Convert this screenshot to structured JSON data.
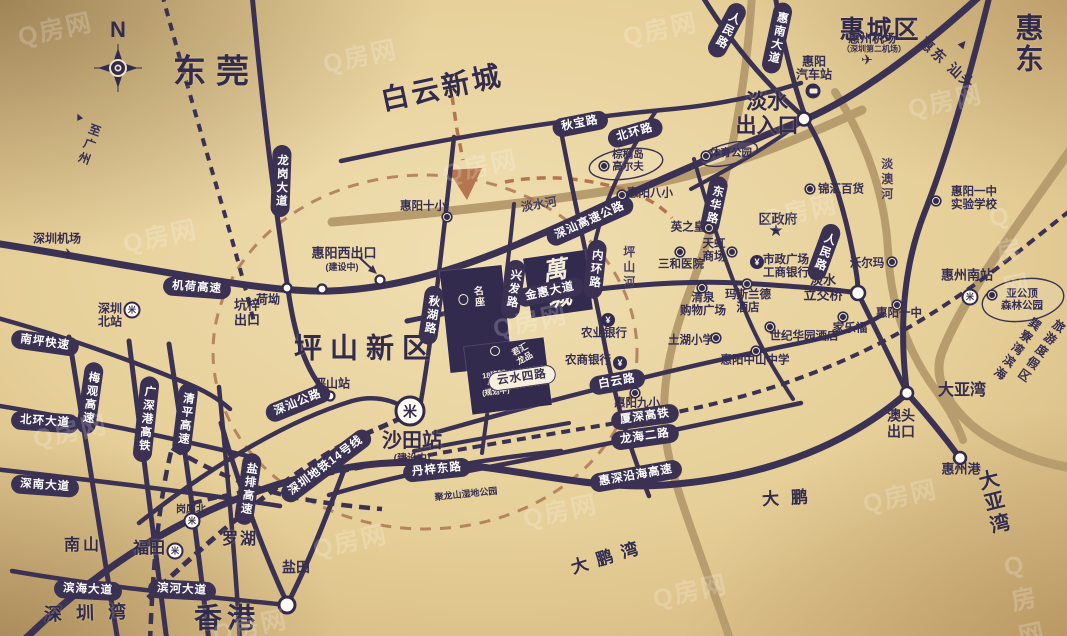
{
  "compass": {
    "label": "N"
  },
  "watermark": {
    "text": "Q房网"
  },
  "colors": {
    "road": "#3b3153",
    "river": "#b79c6d",
    "route_dashed": "#a8724f",
    "pill_bg": "#3b3153",
    "pill_text": "#ffffff",
    "block_bg": "#332b4e",
    "background_gold": "#e6cf98"
  },
  "project": {
    "main_label": "萬城",
    "block_a_label": "名座",
    "school_label": "18班制\n小学\n(规划中)",
    "sub_label": "君汇龙品"
  },
  "labels": [
    {
      "id": "area-dongguan",
      "t": "东莞",
      "x": 216,
      "y": 72,
      "fs": 33,
      "ls": 10,
      "cls": "area"
    },
    {
      "id": "area-baiyun-xincheng",
      "t": "白云新城",
      "x": 442,
      "y": 88,
      "fs": 28,
      "ls": 3,
      "r": -12,
      "cls": "area"
    },
    {
      "id": "area-huichengqu",
      "t": "惠城区",
      "x": 880,
      "y": 30,
      "fs": 25,
      "ls": 2,
      "cls": "area"
    },
    {
      "id": "area-huidong",
      "t": "惠东",
      "x": 1031,
      "y": 44,
      "fs": 28,
      "ls": 3,
      "cls": "area"
    },
    {
      "id": "area-pingshan-xinqu",
      "t": "坪山新区",
      "x": 366,
      "y": 348,
      "fs": 28,
      "ls": 8,
      "cls": "area"
    },
    {
      "id": "area-xianggang",
      "t": "香港",
      "x": 227,
      "y": 618,
      "fs": 28,
      "ls": 5,
      "cls": "area"
    },
    {
      "id": "label-danshui-churukou",
      "t": "淡水\n出入口",
      "x": 767,
      "y": 114,
      "fs": 21,
      "cls": "area"
    },
    {
      "id": "area-shenzhenwan",
      "t": "深圳湾",
      "x": 92,
      "y": 613,
      "fs": 18,
      "ls": 14,
      "r": -2,
      "cls": "area"
    },
    {
      "id": "area-dayawan-bay",
      "t": "大亚湾",
      "x": 1002,
      "y": 501,
      "fs": 20,
      "ls": 15,
      "r": -14,
      "cls": "area"
    },
    {
      "id": "area-dapeng",
      "t": "大鹏",
      "x": 791,
      "y": 498,
      "fs": 17,
      "ls": 12,
      "r": -3,
      "cls": "area"
    },
    {
      "id": "area-dapengwan",
      "t": "大鹏湾",
      "x": 609,
      "y": 557,
      "fs": 17,
      "ls": 9,
      "r": -17,
      "cls": "area"
    },
    {
      "id": "label-dayawan-jct",
      "t": "大亚湾",
      "x": 962,
      "y": 391,
      "fs": 16,
      "cls": "mid"
    },
    {
      "id": "area-nanshan",
      "t": "南山",
      "x": 83,
      "y": 546,
      "fs": 16,
      "ls": 3,
      "cls": "area"
    },
    {
      "id": "area-futian",
      "t": "福田",
      "x": 149,
      "y": 549,
      "fs": 16,
      "cls": "area"
    },
    {
      "id": "area-luohu",
      "t": "罗湖",
      "x": 240,
      "y": 540,
      "fs": 16,
      "ls": 2,
      "cls": "area"
    },
    {
      "id": "label-yantian",
      "t": "盐田",
      "x": 296,
      "y": 568,
      "fs": 14,
      "cls": "mid"
    },
    {
      "id": "label-aotou-chukou",
      "t": "澳头\n出口",
      "x": 901,
      "y": 424,
      "fs": 14,
      "cls": "mid"
    },
    {
      "id": "label-huizhougang",
      "t": "惠州港",
      "x": 961,
      "y": 470,
      "fs": 13,
      "cls": "mid"
    },
    {
      "id": "label-huiyang-xichukou",
      "t": "惠阳西出口",
      "x": 344,
      "y": 254,
      "fs": 13,
      "cls": "mid"
    },
    {
      "id": "label-jianshezhong-xichukou",
      "t": "(建设中)",
      "x": 342,
      "y": 267,
      "fs": 9,
      "cls": "mid"
    },
    {
      "id": "label-heao",
      "t": "荷坳",
      "x": 268,
      "y": 300,
      "fs": 12,
      "cls": "mid"
    },
    {
      "id": "label-kengzi-chukou",
      "t": "坑梓\n出口",
      "x": 247,
      "y": 313,
      "fs": 13,
      "cls": "mid"
    },
    {
      "id": "label-pingshanzhan",
      "t": "坪山站",
      "x": 332,
      "y": 384,
      "fs": 12,
      "cls": "mid"
    },
    {
      "id": "label-shatianzhan",
      "t": "沙田站",
      "x": 412,
      "y": 441,
      "fs": 20,
      "cls": "area"
    },
    {
      "id": "label-jianshezhong-shatian",
      "t": "(建设中)",
      "x": 412,
      "y": 459,
      "fs": 10,
      "cls": "mid"
    },
    {
      "id": "label-julongshan",
      "t": "聚龙山湿地公园",
      "x": 466,
      "y": 494,
      "fs": 9,
      "r": -6,
      "cls": "mid"
    },
    {
      "id": "label-quzhengfu",
      "t": "区政府",
      "x": 778,
      "y": 220,
      "fs": 13,
      "cls": "mid"
    },
    {
      "id": "label-danshui-lijiaoqiao",
      "t": "淡水\n立交桥",
      "x": 823,
      "y": 288,
      "fs": 13,
      "cls": "mid"
    },
    {
      "id": "label-zhi-guangzhou",
      "t": "至广州",
      "x": 88,
      "y": 145,
      "fs": 12,
      "r": 20,
      "v": 1,
      "cls": "mid"
    },
    {
      "id": "label-zhi-guangzhou-arrow",
      "t": "▲",
      "x": 79,
      "y": 117,
      "fs": 11,
      "r": -25,
      "cls": "mid"
    },
    {
      "id": "label-huidong-shantou",
      "t": "惠东 汕头",
      "x": 947,
      "y": 64,
      "fs": 14,
      "r": 42,
      "ls": 2,
      "cls": "mid"
    },
    {
      "id": "label-huidong-shantou-arrow",
      "t": "▲",
      "x": 963,
      "y": 44,
      "fs": 13,
      "r": 40,
      "cls": "mid"
    },
    {
      "id": "label-xunliaowan-1",
      "t": "巽寮湾滨海",
      "x": 1016,
      "y": 349,
      "fs": 12,
      "r": 35,
      "v": 1,
      "cls": "mid"
    },
    {
      "id": "label-xunliaowan-2",
      "t": "旅游度假区",
      "x": 1040,
      "y": 351,
      "fs": 12,
      "r": 35,
      "v": 1,
      "cls": "mid"
    },
    {
      "id": "label-shenzhen-jichang",
      "t": "深圳机场",
      "x": 57,
      "y": 239,
      "fs": 12,
      "cls": "poi"
    },
    {
      "id": "label-shenzhen-beizhan",
      "t": "深圳\n北站",
      "x": 110,
      "y": 316,
      "fs": 12,
      "cls": "poi"
    },
    {
      "id": "label-huizhou-jichang",
      "t": "惠州机场",
      "x": 872,
      "y": 39,
      "fs": 12,
      "cls": "poi"
    },
    {
      "id": "label-huizhou-jichang-sub",
      "t": "（深圳第二机场）",
      "x": 874,
      "y": 50,
      "fs": 8,
      "cls": "poi"
    },
    {
      "id": "label-huiyang-qichezhan",
      "t": "惠阳\n汽车站",
      "x": 814,
      "y": 69,
      "fs": 12,
      "cls": "poi"
    },
    {
      "id": "label-huizhou-nanzhan",
      "t": "惠州南站",
      "x": 967,
      "y": 276,
      "fs": 13,
      "cls": "mid"
    },
    {
      "id": "label-gangxiabei",
      "t": "岗厦北",
      "x": 191,
      "y": 510,
      "fs": 10,
      "cls": "poi"
    },
    {
      "id": "poi-huiyang-shixiao",
      "t": "惠阳十小",
      "x": 423,
      "y": 207,
      "fs": 11.5,
      "cls": "poi"
    },
    {
      "id": "poi-zonglvdao-gaoerfu",
      "t": "棕榈岛\n高尔夫",
      "x": 628,
      "y": 161,
      "fs": 10.5,
      "cls": "poi"
    },
    {
      "id": "poi-huiyang-baxiao",
      "t": "惠阳八小",
      "x": 650,
      "y": 194,
      "fs": 11.5,
      "cls": "poi"
    },
    {
      "id": "poi-tiyu-gongyuan",
      "t": "体育公园",
      "x": 731,
      "y": 154,
      "fs": 10.5,
      "cls": "poi"
    },
    {
      "id": "poi-jinhui-baihuo",
      "t": "锦汇百货",
      "x": 841,
      "y": 190,
      "fs": 11.5,
      "cls": "poi"
    },
    {
      "id": "poi-yingzhihuang",
      "t": "英之皇",
      "x": 688,
      "y": 228,
      "fs": 11.5,
      "cls": "poi"
    },
    {
      "id": "poi-tianhong-shangchang",
      "t": "天虹\n商场",
      "x": 714,
      "y": 251,
      "fs": 11.5,
      "cls": "poi"
    },
    {
      "id": "poi-sanhe-yiyuan",
      "t": "三和医院",
      "x": 681,
      "y": 265,
      "fs": 11.5,
      "cls": "poi"
    },
    {
      "id": "poi-shizheng-guangchang",
      "t": "市政广场\n工商银行",
      "x": 786,
      "y": 267,
      "fs": 11.5,
      "cls": "poi"
    },
    {
      "id": "poi-qingquan-gouwu",
      "t": "清泉\n购物广场",
      "x": 703,
      "y": 305,
      "fs": 11.5,
      "cls": "poi"
    },
    {
      "id": "poi-masilande-jiudian",
      "t": "玛斯兰德\n酒店",
      "x": 748,
      "y": 302,
      "fs": 11.5,
      "cls": "poi"
    },
    {
      "id": "poi-tuhu-xiaoxue",
      "t": "土湖小学",
      "x": 691,
      "y": 341,
      "fs": 11.5,
      "cls": "poi"
    },
    {
      "id": "poi-shiji-huayuan-jiudian",
      "t": "世纪华园酒店",
      "x": 804,
      "y": 337,
      "fs": 11.5,
      "cls": "poi"
    },
    {
      "id": "poi-jialefu",
      "t": "家乐福",
      "x": 850,
      "y": 329,
      "fs": 11.5,
      "cls": "poi"
    },
    {
      "id": "poi-woerma",
      "t": "沃尔玛",
      "x": 867,
      "y": 264,
      "fs": 11.5,
      "cls": "poi"
    },
    {
      "id": "poi-huiyang-yizhong",
      "t": "惠阳一中",
      "x": 899,
      "y": 314,
      "fs": 11.5,
      "cls": "poi"
    },
    {
      "id": "poi-huiyang-yizhong-shiyan",
      "t": "惠阳一中\n实验学校",
      "x": 974,
      "y": 199,
      "fs": 11.5,
      "cls": "poi"
    },
    {
      "id": "poi-huiyang-jiuxiao",
      "t": "惠阳九小",
      "x": 637,
      "y": 404,
      "fs": 11.5,
      "cls": "poi"
    },
    {
      "id": "poi-huiyang-zhongshan",
      "t": "惠阳中山中学",
      "x": 755,
      "y": 361,
      "fs": 11.5,
      "cls": "poi"
    },
    {
      "id": "poi-yagongding",
      "t": "亚公顶\n森林公园",
      "x": 1022,
      "y": 300,
      "fs": 10.5,
      "cls": "poi"
    },
    {
      "id": "poi-nongye-yinhang",
      "t": "农业银行",
      "x": 604,
      "y": 334,
      "fs": 11.5,
      "cls": "poi"
    },
    {
      "id": "poi-nongshang-yinhang",
      "t": "农商银行",
      "x": 588,
      "y": 361,
      "fs": 11.5,
      "cls": "poi"
    },
    {
      "id": "water-danshuihe",
      "t": "淡水河",
      "x": 539,
      "y": 205,
      "fs": 12,
      "r": -10,
      "cls": "water"
    },
    {
      "id": "water-danaohe",
      "t": "淡澳河",
      "x": 886,
      "y": 180,
      "fs": 12,
      "v": 1,
      "cls": "water"
    },
    {
      "id": "water-pingshanhe",
      "t": "坪山河",
      "x": 628,
      "y": 268,
      "fs": 12,
      "v": 1,
      "cls": "water"
    }
  ],
  "pills": [
    {
      "id": "road-jihe-gaosu",
      "t": "机荷高速",
      "x": 197,
      "y": 288,
      "r": 4
    },
    {
      "id": "road-shenshan-gaosu-gonglu",
      "t": "深汕高速公路",
      "x": 590,
      "y": 221,
      "r": -24
    },
    {
      "id": "road-qiubao-lu",
      "t": "秋宝路",
      "x": 580,
      "y": 124,
      "r": -11
    },
    {
      "id": "road-beihuan-lu",
      "t": "北环路",
      "x": 635,
      "y": 133,
      "r": -16
    },
    {
      "id": "road-huinan-dadao",
      "t": "惠南大道",
      "x": 777,
      "y": 38,
      "r": 12,
      "v": 1
    },
    {
      "id": "road-renmin-lu-north",
      "t": "人民路",
      "x": 727,
      "y": 30,
      "r": 28,
      "v": 1
    },
    {
      "id": "road-renmin-lu-south",
      "t": "人民路",
      "x": 824,
      "y": 252,
      "r": 20,
      "v": 1
    },
    {
      "id": "road-donghua-lu",
      "t": "东华路",
      "x": 714,
      "y": 205,
      "r": 12,
      "v": 1
    },
    {
      "id": "road-neihuan-lu",
      "t": "内环路",
      "x": 595,
      "y": 269,
      "r": 6,
      "v": 1
    },
    {
      "id": "road-qiuhu-lu",
      "t": "秋湖路",
      "x": 431,
      "y": 315,
      "r": 8,
      "v": 1
    },
    {
      "id": "road-xingfa-lu",
      "t": "兴发路",
      "x": 513,
      "y": 289,
      "r": 8,
      "v": 1
    },
    {
      "id": "road-longgang-dadao",
      "t": "龙岗大道",
      "x": 281,
      "y": 181,
      "r": 2,
      "v": 1
    },
    {
      "id": "road-jinhui-dadao",
      "t": "金惠大道",
      "x": 550,
      "y": 292,
      "r": -12
    },
    {
      "id": "road-baiyun-lu",
      "t": "白云路",
      "x": 617,
      "y": 382,
      "r": -10
    },
    {
      "id": "road-yunshui-silu",
      "t": "云水四路",
      "x": 522,
      "y": 378,
      "r": -8,
      "white": 1
    },
    {
      "id": "rail-xiashen-gaotie",
      "t": "厦深高铁",
      "x": 645,
      "y": 417,
      "r": -8
    },
    {
      "id": "road-longhai-erlu",
      "t": "龙海二路",
      "x": 645,
      "y": 437,
      "r": -8
    },
    {
      "id": "road-huishen-yanhai-gaosu",
      "t": "惠深沿海高速",
      "x": 636,
      "y": 476,
      "r": -10
    },
    {
      "id": "road-danzi-donglu",
      "t": "丹梓东路",
      "x": 437,
      "y": 470,
      "r": -6
    },
    {
      "id": "road-shenshan-gonglu",
      "t": "深汕公路",
      "x": 298,
      "y": 403,
      "r": -22
    },
    {
      "id": "rail-shenzhen-ditie-14",
      "t": "深圳地铁14号线",
      "x": 326,
      "y": 466,
      "r": -37
    },
    {
      "id": "road-nanping-kuaisu",
      "t": "南坪快速",
      "x": 45,
      "y": 343,
      "r": 8
    },
    {
      "id": "road-meiguan-gaosu",
      "t": "梅观高速",
      "x": 90,
      "y": 398,
      "r": 8,
      "v": 1
    },
    {
      "id": "rail-guangshengang-gaotie",
      "t": "广深港高铁",
      "x": 146,
      "y": 419,
      "r": 6,
      "v": 1
    },
    {
      "id": "road-qingping-gaosu",
      "t": "清平高速",
      "x": 185,
      "y": 419,
      "r": 7,
      "v": 1
    },
    {
      "id": "road-yanpai-gaosu",
      "t": "盐排高速",
      "x": 248,
      "y": 489,
      "r": 8,
      "v": 1
    },
    {
      "id": "road-beihuan-dadao",
      "t": "北环大道",
      "x": 45,
      "y": 422,
      "r": 4
    },
    {
      "id": "road-shennan-dadao",
      "t": "深南大道",
      "x": 45,
      "y": 486,
      "r": 4
    },
    {
      "id": "road-binhai-dadao",
      "t": "滨海大道",
      "x": 88,
      "y": 590,
      "r": 3
    },
    {
      "id": "road-binhe-dadao",
      "t": "滨河大道",
      "x": 182,
      "y": 590,
      "r": 3
    }
  ],
  "dots": [
    {
      "id": "dot-huiyang-shixiao",
      "type": "poi",
      "x": 447,
      "y": 217
    },
    {
      "id": "dot-golf",
      "type": "poi",
      "x": 604,
      "y": 166
    },
    {
      "id": "dot-huiyang-baxiao",
      "type": "poi",
      "x": 622,
      "y": 195
    },
    {
      "id": "dot-jinhui-baihuo",
      "type": "poi",
      "x": 810,
      "y": 189
    },
    {
      "id": "dot-tiyu-gongyuan",
      "type": "poi",
      "x": 706,
      "y": 156
    },
    {
      "id": "dot-yingzhihuang",
      "type": "poi",
      "x": 709,
      "y": 228
    },
    {
      "id": "dot-tianhong",
      "type": "poi",
      "x": 732,
      "y": 252
    },
    {
      "id": "dot-sanhe-yiyuan",
      "type": "poi",
      "x": 680,
      "y": 252
    },
    {
      "id": "dot-qingquan",
      "type": "poi",
      "x": 702,
      "y": 288
    },
    {
      "id": "dot-masilande",
      "type": "poi",
      "x": 747,
      "y": 284
    },
    {
      "id": "dot-tuhu-xiaoxue",
      "type": "poi",
      "x": 716,
      "y": 338
    },
    {
      "id": "dot-shiji-huayuan",
      "type": "poi",
      "x": 770,
      "y": 327
    },
    {
      "id": "dot-jialefu",
      "type": "poi",
      "x": 843,
      "y": 317
    },
    {
      "id": "dot-woerma",
      "type": "poi",
      "x": 892,
      "y": 262
    },
    {
      "id": "dot-huiyang-yizhong",
      "type": "poi",
      "x": 897,
      "y": 305
    },
    {
      "id": "dot-yizhong-shiyan",
      "type": "poi",
      "x": 936,
      "y": 201
    },
    {
      "id": "dot-huiyang-jiuxiao",
      "type": "poi",
      "x": 635,
      "y": 393
    },
    {
      "id": "dot-huiyang-zhongshan",
      "type": "poi",
      "x": 756,
      "y": 351
    },
    {
      "id": "dot-yagongding",
      "type": "poi",
      "x": 992,
      "y": 295
    },
    {
      "id": "dot-school-block",
      "type": "school",
      "x": 495,
      "y": 351
    },
    {
      "id": "dot-nongye-yinhang",
      "type": "yuan",
      "x": 608,
      "y": 320
    },
    {
      "id": "dot-nongshang-yinhang",
      "type": "yuan",
      "x": 620,
      "y": 363
    },
    {
      "id": "dot-gongshang-yinhang",
      "type": "yuan",
      "x": 757,
      "y": 262
    },
    {
      "id": "dot-quzhengfu-star",
      "type": "star",
      "x": 776,
      "y": 231
    },
    {
      "id": "dot-shenzhen-jichang",
      "type": "plane",
      "x": 68,
      "y": 254
    },
    {
      "id": "dot-huizhou-jichang",
      "type": "plane",
      "x": 867,
      "y": 60
    },
    {
      "id": "dot-huiyang-qichezhan",
      "type": "bus",
      "x": 813,
      "y": 91
    },
    {
      "id": "dot-shatianzhan-metro",
      "type": "metro-big",
      "x": 410,
      "y": 411
    },
    {
      "id": "dot-futian-metro",
      "type": "metro",
      "x": 175,
      "y": 551
    },
    {
      "id": "dot-gangxiabei-metro",
      "type": "metro",
      "x": 192,
      "y": 521
    },
    {
      "id": "dot-shenzhen-beizhan",
      "type": "metro",
      "x": 132,
      "y": 310
    },
    {
      "id": "dot-huizhou-nanzhan",
      "type": "metro",
      "x": 970,
      "y": 297
    }
  ],
  "glyphs": {
    "yuan": "¥",
    "star": "★",
    "plane": "✈",
    "metro": "米"
  },
  "watermarks": [
    {
      "x": 55,
      "y": 28
    },
    {
      "x": 360,
      "y": 55
    },
    {
      "x": 660,
      "y": 28
    },
    {
      "x": 945,
      "y": 100
    },
    {
      "x": 160,
      "y": 235
    },
    {
      "x": 480,
      "y": 165
    },
    {
      "x": 800,
      "y": 210
    },
    {
      "x": 1020,
      "y": 250
    },
    {
      "x": 70,
      "y": 430
    },
    {
      "x": 350,
      "y": 540
    },
    {
      "x": 560,
      "y": 510
    },
    {
      "x": 690,
      "y": 590
    },
    {
      "x": 900,
      "y": 495
    },
    {
      "x": 1030,
      "y": 600
    },
    {
      "x": 250,
      "y": 625
    },
    {
      "x": 530,
      "y": 320
    }
  ]
}
